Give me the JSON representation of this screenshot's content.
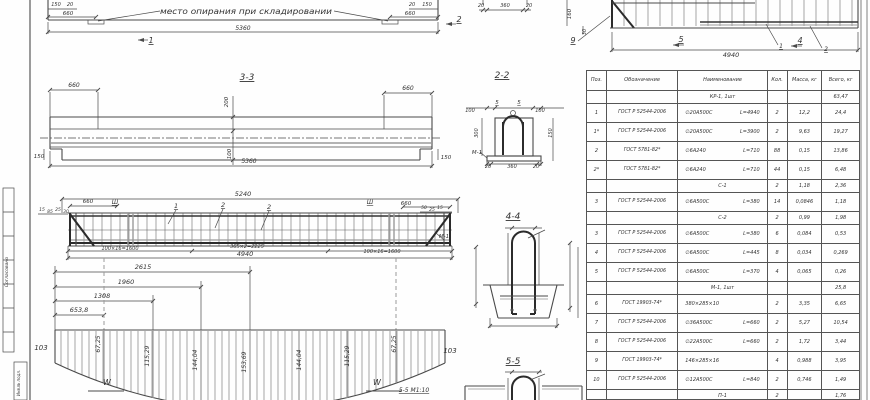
{
  "colors": {
    "line": "#4a4a4a",
    "gray": "#9a9a9a",
    "text": "#333333",
    "bg": "#fefefe"
  },
  "annotations": {
    "frame": [
      {
        "t": "Согласовано",
        "x": 8,
        "y": 272,
        "r": -90,
        "s": 4.5
      },
      {
        "t": "Инв.№ подл.",
        "x": 20,
        "y": 383,
        "r": -90,
        "s": 4
      }
    ],
    "storage": [
      {
        "t": "150",
        "x": 56,
        "y": 6,
        "s": 5
      },
      {
        "t": "20",
        "x": 70,
        "y": 6,
        "s": 5
      },
      {
        "t": "660",
        "x": 68,
        "y": 15,
        "s": 5.5
      },
      {
        "t": "место опирания при складировании",
        "x": 246,
        "y": 14,
        "s": 7.5,
        "w": 172
      },
      {
        "t": "5360",
        "x": 243,
        "y": 30,
        "s": 6
      },
      {
        "t": "1",
        "x": 151,
        "y": 43,
        "s": 8,
        "u": 1
      },
      {
        "t": "20",
        "x": 412,
        "y": 6,
        "s": 5
      },
      {
        "t": "150",
        "x": 427,
        "y": 6,
        "s": 5
      },
      {
        "t": "660",
        "x": 410,
        "y": 15,
        "s": 5.5
      },
      {
        "t": "2",
        "x": 459,
        "y": 22,
        "s": 8,
        "u": 1
      }
    ],
    "top_section": [
      {
        "t": "20",
        "x": 481,
        "y": 7,
        "s": 5
      },
      {
        "t": "360",
        "x": 505,
        "y": 7,
        "s": 5
      },
      {
        "t": "20",
        "x": 529,
        "y": 7,
        "s": 5
      }
    ],
    "cage_top": [
      {
        "t": "160",
        "x": 571,
        "y": 14,
        "r": -90,
        "s": 5.5
      },
      {
        "t": "30",
        "x": 586,
        "y": 32,
        "r": -90,
        "s": 5
      },
      {
        "t": "9",
        "x": 573,
        "y": 43,
        "s": 8,
        "u": 1
      },
      {
        "t": "5",
        "x": 681,
        "y": 42,
        "s": 8,
        "u": 1
      },
      {
        "t": "4940",
        "x": 731,
        "y": 57,
        "s": 6.5
      },
      {
        "t": "1",
        "x": 781,
        "y": 48,
        "s": 6,
        "u": 1
      },
      {
        "t": "4",
        "x": 800,
        "y": 43,
        "s": 8,
        "u": 1
      },
      {
        "t": "2",
        "x": 826,
        "y": 51,
        "s": 6,
        "u": 1
      }
    ],
    "section33": [
      {
        "t": "3-3",
        "x": 247,
        "y": 80,
        "s": 9,
        "u": 1
      },
      {
        "t": "660",
        "x": 74,
        "y": 87,
        "s": 6
      },
      {
        "t": "660",
        "x": 408,
        "y": 90,
        "s": 6
      },
      {
        "t": "200",
        "x": 228,
        "y": 102,
        "r": -90,
        "s": 5.5
      },
      {
        "t": "100",
        "x": 231,
        "y": 154,
        "r": -90,
        "s": 5.5
      },
      {
        "t": "5360",
        "x": 249,
        "y": 163,
        "s": 6
      },
      {
        "t": "150",
        "x": 39,
        "y": 158,
        "s": 5.5
      },
      {
        "t": "150",
        "x": 446,
        "y": 159,
        "s": 5.5
      }
    ],
    "section22": [
      {
        "t": "2-2",
        "x": 502,
        "y": 78,
        "s": 9,
        "u": 1
      },
      {
        "t": "100",
        "x": 470,
        "y": 112,
        "s": 5
      },
      {
        "t": "5",
        "x": 497,
        "y": 104,
        "s": 5.5,
        "u": 1
      },
      {
        "t": "5",
        "x": 519,
        "y": 104,
        "s": 5.5,
        "u": 1
      },
      {
        "t": "100",
        "x": 540,
        "y": 112,
        "s": 5
      },
      {
        "t": "300",
        "x": 478,
        "y": 133,
        "r": -90,
        "s": 5
      },
      {
        "t": "150",
        "x": 552,
        "y": 133,
        "r": -90,
        "s": 5
      },
      {
        "t": "М-1",
        "x": 477,
        "y": 154,
        "s": 5.5
      },
      {
        "t": "20",
        "x": 488,
        "y": 168,
        "s": 5
      },
      {
        "t": "360",
        "x": 512,
        "y": 168,
        "s": 5
      },
      {
        "t": "20",
        "x": 536,
        "y": 168,
        "s": 5
      }
    ],
    "cage": [
      {
        "t": "5240",
        "x": 243,
        "y": 196,
        "s": 6.5
      },
      {
        "t": "660",
        "x": 88,
        "y": 203,
        "s": 5.5
      },
      {
        "t": "Ш",
        "x": 115,
        "y": 204,
        "s": 6,
        "u": 1
      },
      {
        "t": "Ш",
        "x": 370,
        "y": 204,
        "s": 6,
        "u": 1
      },
      {
        "t": "660",
        "x": 406,
        "y": 205,
        "s": 5.5
      },
      {
        "t": "1",
        "x": 176,
        "y": 208,
        "s": 6.5,
        "u": 1
      },
      {
        "t": "2",
        "x": 223,
        "y": 207,
        "s": 6.5,
        "u": 1
      },
      {
        "t": "2",
        "x": 269,
        "y": 209,
        "s": 6.5,
        "u": 1
      },
      {
        "t": "15",
        "x": 42,
        "y": 211,
        "s": 4.5
      },
      {
        "t": "85",
        "x": 50,
        "y": 213,
        "s": 4.5
      },
      {
        "t": "25",
        "x": 58,
        "y": 211,
        "s": 4.5
      },
      {
        "t": "30",
        "x": 66,
        "y": 213,
        "s": 4.5
      },
      {
        "t": "50",
        "x": 424,
        "y": 209,
        "s": 4.5
      },
      {
        "t": "25",
        "x": 432,
        "y": 211,
        "s": 4.5
      },
      {
        "t": "15",
        "x": 440,
        "y": 209,
        "s": 4.5
      },
      {
        "t": "М-1",
        "x": 444,
        "y": 238,
        "s": 5.5
      },
      {
        "t": "100×16=1600",
        "x": 120,
        "y": 250,
        "s": 5
      },
      {
        "t": "365×2=2225",
        "x": 247,
        "y": 248,
        "s": 5
      },
      {
        "t": "100×16=1600",
        "x": 382,
        "y": 253,
        "s": 5
      },
      {
        "t": "4940",
        "x": 245,
        "y": 256,
        "s": 6.5
      }
    ],
    "diagram": [
      {
        "t": "2615",
        "x": 143,
        "y": 269,
        "s": 6.5
      },
      {
        "t": "1960",
        "x": 126,
        "y": 284,
        "s": 6.5
      },
      {
        "t": "1308",
        "x": 102,
        "y": 298,
        "s": 6.5
      },
      {
        "t": "653,8",
        "x": 79,
        "y": 312,
        "s": 6.5
      },
      {
        "t": "103",
        "x": 41,
        "y": 350,
        "s": 7
      },
      {
        "t": "103",
        "x": 450,
        "y": 353,
        "s": 7
      },
      {
        "t": "67,25",
        "x": 100,
        "y": 344,
        "r": -90,
        "s": 6
      },
      {
        "t": "115,29",
        "x": 149,
        "y": 356,
        "r": -90,
        "s": 6
      },
      {
        "t": "144,04",
        "x": 197,
        "y": 360,
        "r": -90,
        "s": 6
      },
      {
        "t": "153,69",
        "x": 246,
        "y": 362,
        "r": -90,
        "s": 6
      },
      {
        "t": "144,04",
        "x": 301,
        "y": 360,
        "r": -90,
        "s": 6
      },
      {
        "t": "115,29",
        "x": 349,
        "y": 356,
        "r": -90,
        "s": 6
      },
      {
        "t": "67,25",
        "x": 396,
        "y": 344,
        "r": -90,
        "s": 6
      },
      {
        "t": "W",
        "x": 107,
        "y": 385,
        "s": 8
      },
      {
        "t": "W",
        "x": 377,
        "y": 385,
        "s": 8
      },
      {
        "t": "5-5 М1:10",
        "x": 414,
        "y": 392,
        "s": 6,
        "u": 1
      }
    ],
    "section44": [
      {
        "t": "4-4",
        "x": 513,
        "y": 219,
        "s": 9,
        "u": 1
      }
    ],
    "section55": [
      {
        "t": "5-5",
        "x": 513,
        "y": 364,
        "s": 9,
        "u": 1
      }
    ]
  },
  "table": {
    "headers": [
      "Поз.",
      "Обозначение",
      "Наименование",
      "Кол.",
      "Масса, кг",
      "Всего, кг"
    ],
    "rows": [
      {
        "h": 13,
        "group": true,
        "name": "КР-1, 1шт",
        "pos": "",
        "doc": "",
        "qty": "",
        "mass": "",
        "total": "63,47"
      },
      {
        "h": 19,
        "pos": "1",
        "doc": "ГОСТ Р 52544-2006",
        "spec": "∅20А500С",
        "len": "L=4940",
        "qty": "2",
        "mass": "12,2",
        "total": "24,4"
      },
      {
        "h": 19,
        "pos": "1*",
        "doc": "ГОСТ Р 52544-2006",
        "spec": "∅20А500С",
        "len": "L=3900",
        "qty": "2",
        "mass": "9,63",
        "total": "19,27"
      },
      {
        "h": 19,
        "pos": "2",
        "doc": "ГОСТ 5781-82*",
        "spec": "∅6А240",
        "len": "L=710",
        "qty": "88",
        "mass": "0,15",
        "total": "13,86"
      },
      {
        "h": 19,
        "pos": "2*",
        "doc": "ГОСТ 5781-82*",
        "spec": "∅6А240",
        "len": "L=710",
        "qty": "44",
        "mass": "0,15",
        "total": "6,48"
      },
      {
        "h": 13,
        "group": true,
        "name": "С-1",
        "pos": "",
        "doc": "",
        "qty": "2",
        "mass": "1,18",
        "total": "2,36"
      },
      {
        "h": 19,
        "pos": "3",
        "doc": "ГОСТ Р 52544-2006",
        "spec": "∅6А500С",
        "len": "L=380",
        "qty": "14",
        "mass": "0,0846",
        "total": "1,18"
      },
      {
        "h": 13,
        "group": true,
        "name": "С-2",
        "pos": "",
        "doc": "",
        "qty": "2",
        "mass": "0,99",
        "total": "1,98"
      },
      {
        "h": 19,
        "pos": "3",
        "doc": "ГОСТ Р 52544-2006",
        "spec": "∅6А500С",
        "len": "L=380",
        "qty": "6",
        "mass": "0,084",
        "total": "0,53"
      },
      {
        "h": 19,
        "pos": "4",
        "doc": "ГОСТ Р 52544-2006",
        "spec": "∅6А500С",
        "len": "L=445",
        "qty": "8",
        "mass": "0,034",
        "total": "0,269"
      },
      {
        "h": 19,
        "pos": "5",
        "doc": "ГОСТ Р 52544-2006",
        "spec": "∅6А500С",
        "len": "L=370",
        "qty": "4",
        "mass": "0,065",
        "total": "0,26"
      },
      {
        "h": 13,
        "group": true,
        "name": "М-1, 1шт",
        "pos": "",
        "doc": "",
        "qty": "",
        "mass": "",
        "total": "25,8"
      },
      {
        "h": 19,
        "pos": "6",
        "doc": "ГОСТ 19903-74*",
        "spec": "380×285×10",
        "len": "",
        "qty": "2",
        "mass": "3,35",
        "total": "6,65"
      },
      {
        "h": 19,
        "pos": "7",
        "doc": "ГОСТ Р 52544-2006",
        "spec": "∅36А500С",
        "len": "L=660",
        "qty": "2",
        "mass": "5,27",
        "total": "10,54"
      },
      {
        "h": 19,
        "pos": "8",
        "doc": "ГОСТ Р 52544-2006",
        "spec": "∅22А500С",
        "len": "L=660",
        "qty": "2",
        "mass": "1,72",
        "total": "3,44"
      },
      {
        "h": 19,
        "pos": "9",
        "doc": "ГОСТ 19903-74*",
        "spec": "146×285×16",
        "len": "",
        "qty": "4",
        "mass": "0,988",
        "total": "3,95"
      },
      {
        "h": 19,
        "pos": "10",
        "doc": "ГОСТ Р 52544-2006",
        "spec": "∅12А500С",
        "len": "L=840",
        "qty": "2",
        "mass": "0,746",
        "total": "1,49"
      },
      {
        "h": 13,
        "group": true,
        "name": "П-1",
        "pos": "",
        "doc": "",
        "qty": "2",
        "mass": "",
        "total": "1,76"
      }
    ]
  }
}
